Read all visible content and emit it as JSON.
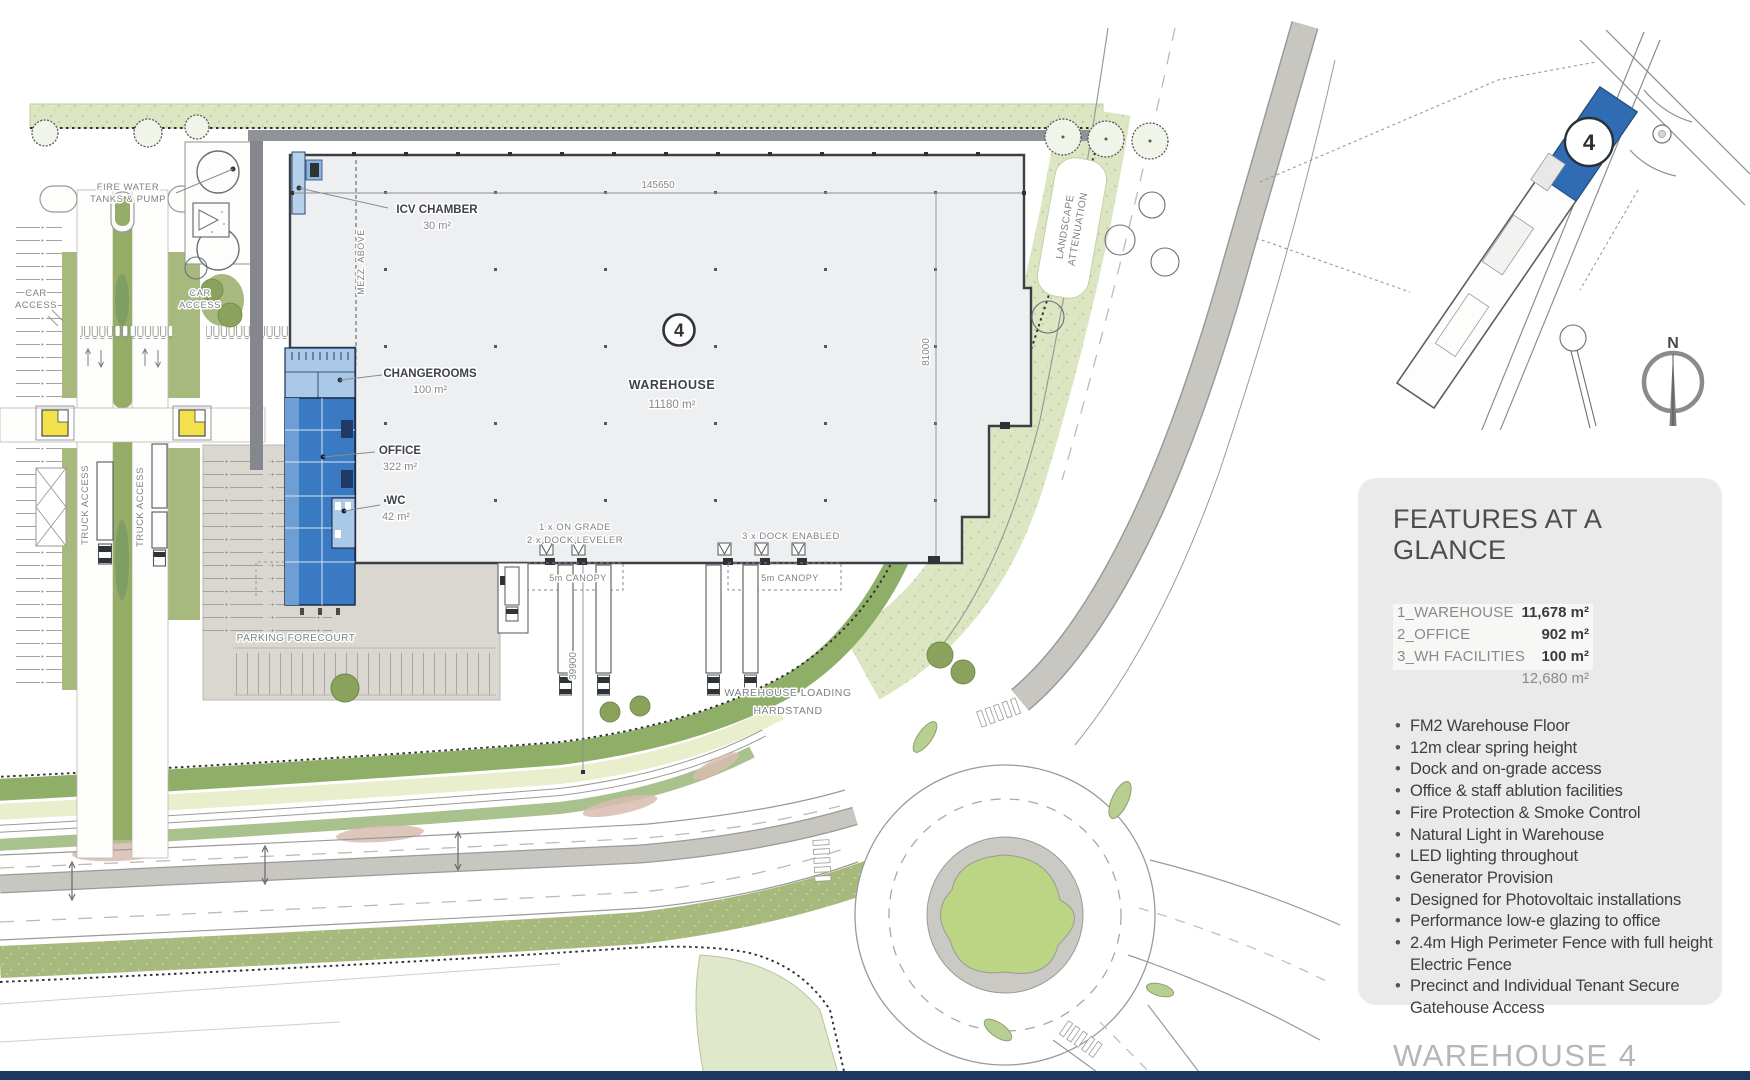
{
  "colors": {
    "accent_blue": "#2f6cb4",
    "office_blue": "#3a7ac2",
    "light_blue": "#aac9e9",
    "navy_bar": "#1c3860",
    "green_band": "#dde6c3",
    "green_verge": "#a7b97c",
    "roundabout_island": "#bcd584",
    "gatehouse_yellow": "#f3e14b",
    "tarmac_gray": "#d9d7d0"
  },
  "plan": {
    "building_badge": "4",
    "dimensions": {
      "top": "145650",
      "right": "81000",
      "hardstand": "39900"
    },
    "rooms": {
      "icv": {
        "name": "ICV CHAMBER",
        "area": "30 m²"
      },
      "changerooms": {
        "name": "CHANGEROOMS",
        "area": "100 m²"
      },
      "office": {
        "name": "OFFICE",
        "area": "322 m²"
      },
      "wc": {
        "name": "WC",
        "area": "42 m²"
      },
      "warehouse": {
        "name": "WAREHOUSE",
        "area": "11180 m²"
      }
    },
    "labels": {
      "fire_water": [
        "FIRE WATER",
        "TANKS & PUMP"
      ],
      "car_access": [
        "CAR",
        "ACCESS"
      ],
      "truck_access": "TRUCK ACCESS",
      "mezz": "MEZZ. ABOVE",
      "landscape": [
        "LANDSCAPE",
        "ATTENUATION"
      ],
      "parking_forecourt": "PARKING FORECOURT",
      "loading": [
        "WAREHOUSE LOADING",
        "HARDSTAND"
      ],
      "docks_left": [
        "1 x ON GRADE",
        "2 x DOCK LEVELER"
      ],
      "docks_right": "3 x DOCK ENABLED",
      "canopy": "5m CANOPY"
    }
  },
  "locator": {
    "badge": "4",
    "north": "N"
  },
  "features": {
    "title": "FEATURES AT A GLANCE",
    "areas": [
      {
        "label": "1_WAREHOUSE",
        "value": "11,678 m²"
      },
      {
        "label": "2_OFFICE",
        "value": "902 m²"
      },
      {
        "label": "3_WH FACILITIES",
        "value": "100 m²"
      }
    ],
    "total": "12,680 m²",
    "bullets": [
      "FM2 Warehouse Floor",
      "12m clear spring height",
      "Dock and on-grade access",
      "Office & staff ablution facilities",
      "Fire Protection & Smoke Control",
      "Natural Light in Warehouse",
      "LED lighting throughout",
      "Generator Provision",
      "Designed for Photovoltaic installations",
      "Performance low-e glazing to office",
      "2.4m High Perimeter Fence with full height Electric Fence",
      "Precinct and Individual Tenant Secure Gatehouse Access"
    ]
  },
  "footer": {
    "title": "WAREHOUSE 4"
  }
}
